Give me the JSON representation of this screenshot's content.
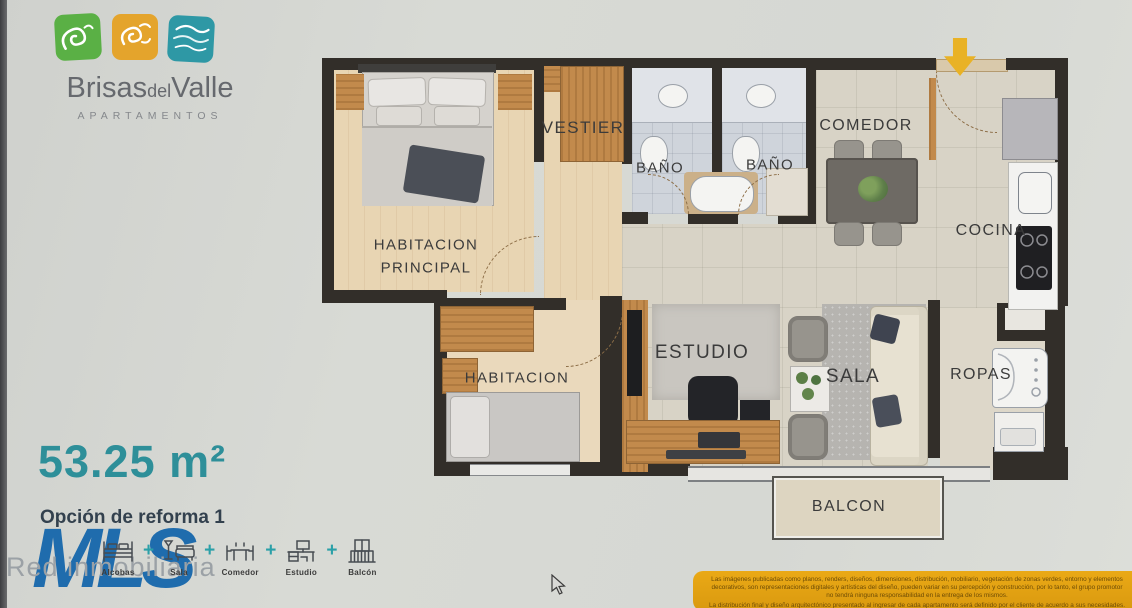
{
  "brand": {
    "name_word1": "Brisas",
    "name_word2": "del",
    "name_word3": "Valle",
    "subtitle": "APARTAMENTOS",
    "logo_colors": {
      "green": "#5ab045",
      "yellow": "#e4a42c",
      "teal": "#2e98a5"
    }
  },
  "area": {
    "value": "53.25 m²"
  },
  "option": {
    "label": "Opción de reforma 1"
  },
  "agency": {
    "initials": "MLS",
    "name": "Red inmobiliaria"
  },
  "entrance": {
    "arrow_color": "#e9b226"
  },
  "rooms": {
    "vestier": "VESTIER",
    "bano_1": "BAÑO",
    "bano_2": "BAÑO",
    "comedor": "COMEDOR",
    "cocina": "COCINA",
    "habitacion_principal_line1": "HABITACION",
    "habitacion_principal_line2": "PRINCIPAL",
    "habitacion": "HABITACION",
    "estudio": "ESTUDIO",
    "sala": "SALA",
    "ropas": "ROPAS",
    "balcon": "BALCON"
  },
  "legend": {
    "separator": "+",
    "items": [
      {
        "icon": "bed-icon",
        "label": "Alcobas"
      },
      {
        "icon": "sofa-icon",
        "label": "Sala"
      },
      {
        "icon": "dining-table-icon",
        "label": "Comedor"
      },
      {
        "icon": "desk-icon",
        "label": "Estudio"
      },
      {
        "icon": "balcony-icon",
        "label": "Balcón"
      }
    ]
  },
  "disclaimer": {
    "lines": [
      "Las imágenes publicadas como planos, renders, diseños, dimensiones, distribución, mobiliario, vegetación de zonas verdes, entorno y elementos",
      "decorativos, son representaciones digitales y artísticas del diseño, pueden variar en su percepción y construcción, por lo tanto, el grupo promotor",
      "no tendrá ninguna responsabilidad en la entrega de los mismos.",
      "La distribución final y diseño arquitectónico presentado al ingresar de cada apartamento será definido por el cliente de acuerdo a sus necesidades."
    ]
  },
  "colors": {
    "accent_teal": "#2e8f99",
    "brand_blue": "#1f6cad",
    "wall": "#322e29",
    "highlight_yellow": "#e8a81c"
  }
}
